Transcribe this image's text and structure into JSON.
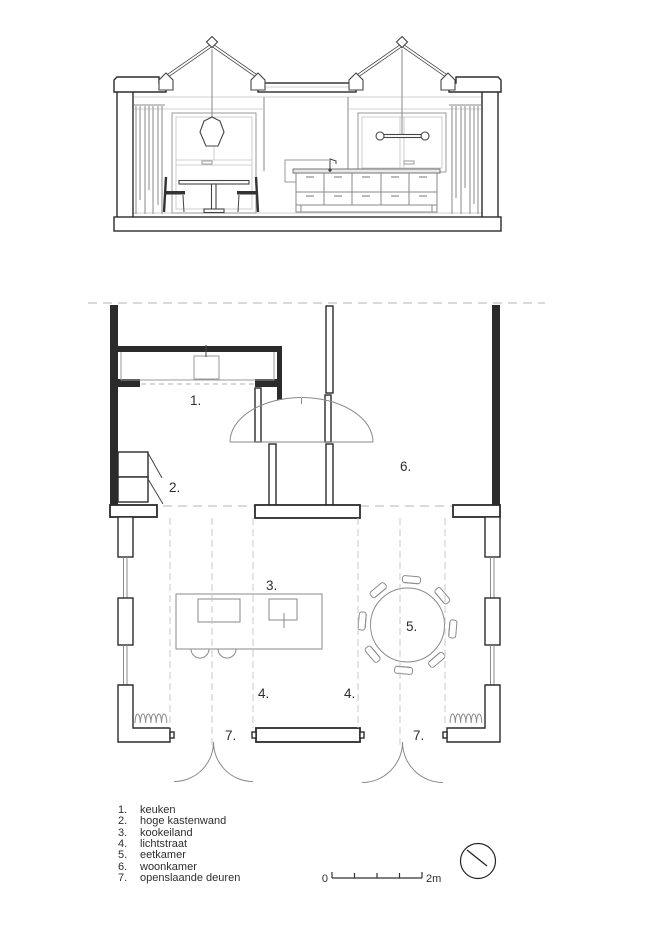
{
  "drawing": {
    "type": "architectural drawing: building section above, floor plan below",
    "colors": {
      "ink": "#2b2b2b",
      "furniture_line": "#8a8a8a",
      "dashed": "#c4c4c4",
      "text": "#2e2e2e",
      "paper": "#ffffff"
    }
  },
  "plan_labels": {
    "keuken": "1.",
    "hoge_kastenwand": "2.",
    "kookeiland": "3.",
    "lichtstraat_left": "4.",
    "lichtstraat_right": "4.",
    "eetkamer": "5.",
    "woonkamer": "6.",
    "openslaande_deuren_left": "7.",
    "openslaande_deuren_right": "7."
  },
  "legend": {
    "items": [
      {
        "num": "1.",
        "label": "keuken"
      },
      {
        "num": "2.",
        "label": "hoge kastenwand"
      },
      {
        "num": "3.",
        "label": "kookeiland"
      },
      {
        "num": "4.",
        "label": "lichtstraat"
      },
      {
        "num": "5.",
        "label": "eetkamer"
      },
      {
        "num": "6.",
        "label": "woonkamer"
      },
      {
        "num": "7.",
        "label": "openslaande deuren"
      }
    ]
  },
  "scale_bar": {
    "zero": "0",
    "max": "2m"
  }
}
